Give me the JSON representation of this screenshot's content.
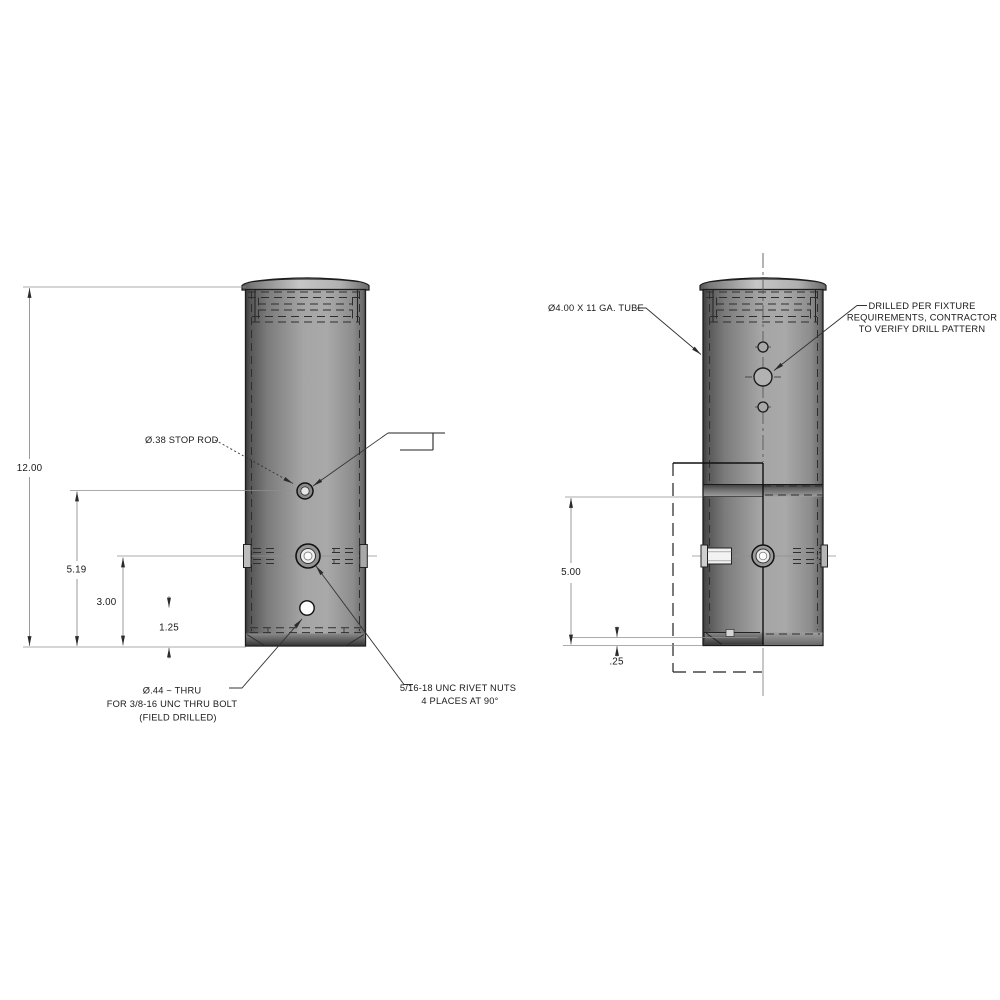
{
  "drawing": {
    "left_view": {
      "dims": {
        "overall_height": "12.00",
        "stop_rod_height": "5.19",
        "rivet_height": "3.00",
        "hole_height": "1.25"
      },
      "labels": {
        "stop_rod": "Ø.38 STOP ROD",
        "thru_hole": [
          "Ø.44 ~ THRU",
          "FOR 3/8-16 UNC THRU BOLT",
          "(FIELD DRILLED)"
        ],
        "rivet_nuts": [
          "5/16-18 UNC RIVET NUTS",
          "4 PLACES AT 90°"
        ]
      }
    },
    "right_view": {
      "dims": {
        "slot_height": "5.00",
        "slot_offset": ".25"
      },
      "labels": {
        "tube": "Ø4.00 X 11 GA. TUBE",
        "drill_pattern": [
          "DRILLED PER FIXTURE",
          "REQUIREMENTS, CONTRACTOR",
          "TO VERIFY DRILL PATTERN"
        ]
      }
    },
    "colors": {
      "outline": "#1c1c1c",
      "dim_lines": "#8f8f8f",
      "tube_light": "#a9a9a9",
      "tube_dark": "#3b3b3b"
    }
  }
}
